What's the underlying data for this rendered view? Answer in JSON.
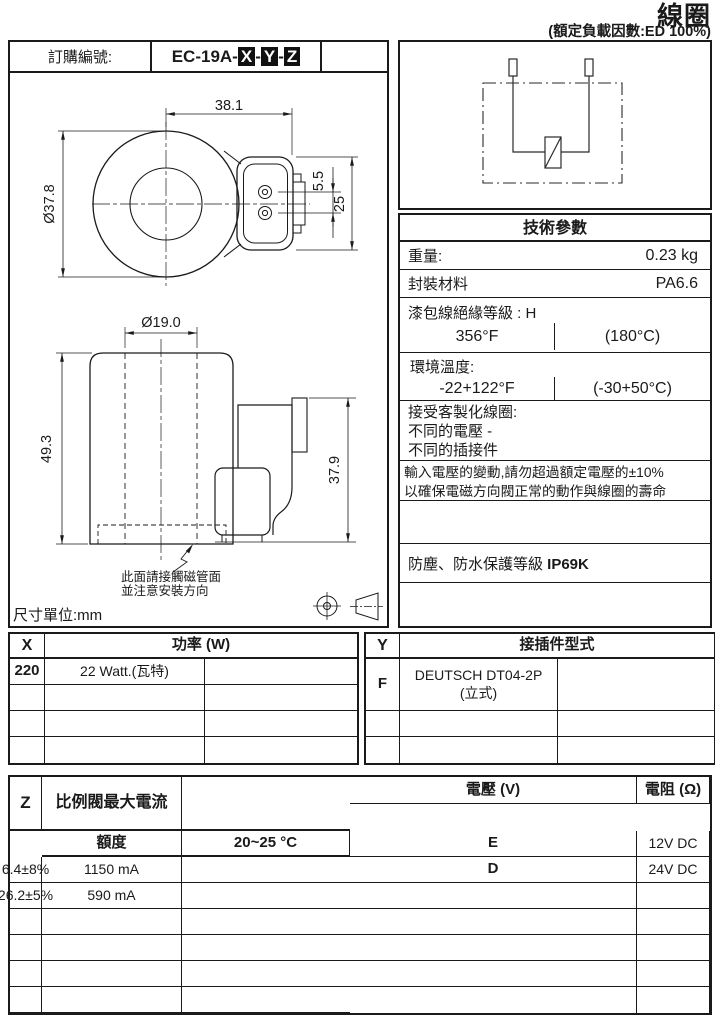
{
  "page": {
    "title": "線圈",
    "subtitle": "(額定負載因數:ED 100%)"
  },
  "order": {
    "label": "訂購編號:",
    "prefix": "EC-19A-",
    "x": "X",
    "sep1": "-",
    "y": "Y",
    "sep2": "-",
    "z": "Z"
  },
  "drawing": {
    "unit": "尺寸單位:mm",
    "top_width": "38.1",
    "top_diameter": "Ø37.8",
    "pin_gap": "5.5",
    "conn_height": "25",
    "bore": "Ø19.0",
    "body_height": "49.3",
    "conn_side_height": "37.9",
    "note1": "此面請接觸磁管面",
    "note2": "並注意安裝方向"
  },
  "tech": {
    "title": "技術參數",
    "weight_label": "重量:",
    "weight_value": "0.23 kg",
    "material_label": "封裝材料",
    "material_value": "PA6.6",
    "insul_label": "漆包線絕緣等級 : H",
    "insul_f": "356°F",
    "insul_c": "(180°C)",
    "ambient_label": "環境溫度:",
    "ambient_f": "-22+122°F",
    "ambient_c": "(-30+50°C)",
    "custom1": "接受客製化線圈:",
    "custom2": "不同的電壓 -",
    "custom3": "不同的插接件",
    "note1": "輸入電壓的變動,請勿超過額定電壓的±10%",
    "note2": "以確保電磁方向閥正常的動作與線圈的壽命",
    "protect_label": "防塵、防水保護等級 ",
    "protect_value": "IP69K"
  },
  "table_x": {
    "key": "X",
    "header": "功率 (W)",
    "rows": [
      {
        "code": "220",
        "value": "22 Watt.(瓦特)",
        "extra": ""
      },
      {
        "code": "",
        "value": "",
        "extra": ""
      },
      {
        "code": "",
        "value": "",
        "extra": ""
      },
      {
        "code": "",
        "value": "",
        "extra": ""
      }
    ]
  },
  "table_y": {
    "key": "Y",
    "header": "接插件型式",
    "rows": [
      {
        "code": "F",
        "line1": "DEUTSCH DT04-2P",
        "line2": "(立式)",
        "extra": ""
      },
      {
        "code": "",
        "line1": "",
        "line2": "",
        "extra": ""
      },
      {
        "code": "",
        "line1": "",
        "line2": "",
        "extra": ""
      }
    ]
  },
  "table_z": {
    "key": "Z",
    "voltage_header": "電壓 (V)",
    "voltage_sub": "額度",
    "resistance_header": "電阻 (Ω)",
    "resistance_sub": "20~25 °C",
    "current_header": "比例閥最大電流",
    "rows": [
      {
        "code": "E",
        "voltage": "12V DC",
        "resistance": "6.4±8%",
        "current": "1150 mA",
        "extra": ""
      },
      {
        "code": "D",
        "voltage": "24V DC",
        "resistance": "26.2±5%",
        "current": "590 mA",
        "extra": ""
      },
      {
        "code": "",
        "voltage": "",
        "resistance": "",
        "current": "",
        "extra": ""
      },
      {
        "code": "",
        "voltage": "",
        "resistance": "",
        "current": "",
        "extra": ""
      },
      {
        "code": "",
        "voltage": "",
        "resistance": "",
        "current": "",
        "extra": ""
      },
      {
        "code": "",
        "voltage": "",
        "resistance": "",
        "current": "",
        "extra": ""
      },
      {
        "code": "",
        "voltage": "",
        "resistance": "",
        "current": "",
        "extra": ""
      }
    ]
  }
}
